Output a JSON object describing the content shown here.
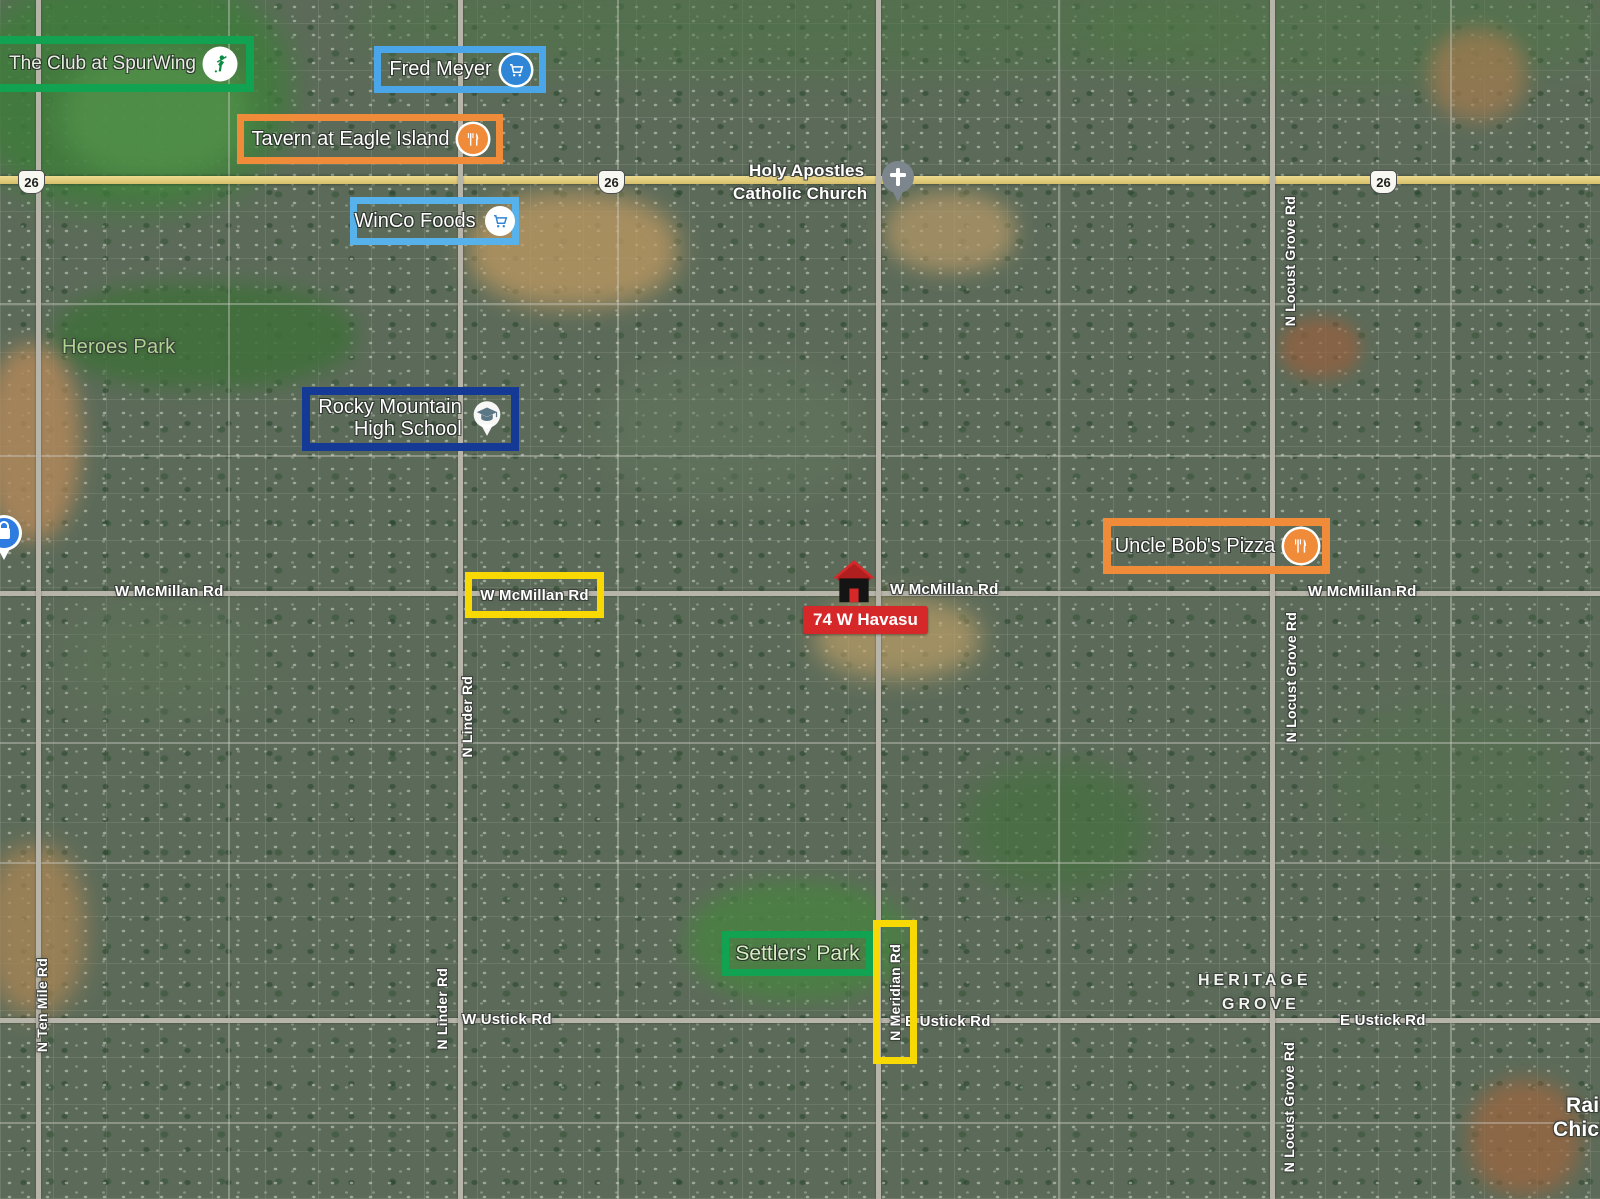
{
  "colors": {
    "green_box": "#12a352",
    "blue_box": "#4aa6e8",
    "light_blue_box": "#57b2ec",
    "orange_box": "#f08b3a",
    "navy_box": "#153a96",
    "yellow_box": "#f8d903",
    "red_marker": "#d62828",
    "park_text": "#aed492",
    "road_label_text": "#ffffff"
  },
  "pois": [
    {
      "label": "The Club at SpurWing",
      "icon": "golfer-icon",
      "box_color": "#12a352"
    },
    {
      "label": "Fred Meyer",
      "icon": "shopping-cart-icon",
      "box_color": "#4aa6e8"
    },
    {
      "label": "Tavern at Eagle Island",
      "icon": "restaurant-icon",
      "box_color": "#f08b3a"
    },
    {
      "label": "WinCo Foods",
      "icon": "shopping-cart-icon",
      "box_color": "#57b2ec"
    },
    {
      "line1": "Rocky Mountain",
      "line2": "High School",
      "icon": "graduation-cap-icon",
      "box_color": "#153a96"
    },
    {
      "label": "Uncle Bob's Pizza",
      "icon": "restaurant-icon",
      "box_color": "#f08b3a"
    },
    {
      "label": "Settlers' Park",
      "icon": null,
      "box_color": "#12a352"
    }
  ],
  "highlight_boxes": [
    {
      "label": "W McMillan Rd",
      "color": "#f8d903"
    },
    {
      "label": "N Meridian Rd",
      "color": "#f8d903"
    }
  ],
  "marker": {
    "label": "74 W Havasu",
    "icon": "house-icon",
    "color": "#d62828"
  },
  "church": {
    "line1": "Holy Apostles",
    "line2": "Catholic Church",
    "icon": "cross-pin-icon"
  },
  "parks": {
    "heroes": "Heroes Park"
  },
  "neighborhood": {
    "line1": "HERITAGE",
    "line2": "GROVE"
  },
  "partial_labels": {
    "line1": "Rais",
    "line2": "Chick"
  },
  "road_labels": {
    "mcmillan_left": "W McMillan Rd",
    "mcmillan_mid": "W McMillan Rd",
    "mcmillan_right": "W McMillan Rd",
    "linder": "N Linder Rd",
    "linder_south": "N Linder Rd",
    "ten_mile": "N Ten Mile Rd",
    "locust_grove_north": "N Locust Grove Rd",
    "locust_grove_mid": "N Locust Grove Rd",
    "locust_grove_south": "N Locust Grove Rd",
    "ustick_west": "W Ustick Rd",
    "ustick_east_mid": "E Ustick Rd",
    "ustick_east": "E Ustick Rd"
  },
  "route_shields": [
    {
      "number": "26"
    },
    {
      "number": "26"
    },
    {
      "number": "26"
    }
  ]
}
